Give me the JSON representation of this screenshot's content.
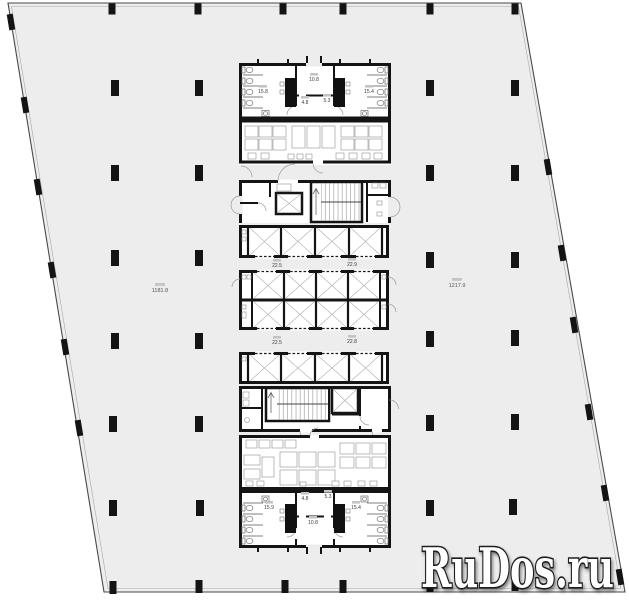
{
  "watermark": {
    "text": "RuDos.ru"
  },
  "plan": {
    "labels": {
      "hall_left": "1181.8",
      "hall_right": "1217.9",
      "corridor_top": "10.8",
      "wc_top_left": "15.8",
      "wc_top_right": "15.4",
      "room_top_left": "4.8",
      "room_top_right": "5.3",
      "lift_hall_upper_left": "22.5",
      "lift_hall_upper_right": "22.9",
      "lift_hall_lower_left": "22.5",
      "lift_hall_lower_right": "22.8",
      "room_bottom_left": "4.8",
      "room_bottom_right": "5.3",
      "wc_bottom_left": "15.9",
      "wc_bottom_right": "15.4",
      "corridor_bottom": "10.8"
    }
  }
}
